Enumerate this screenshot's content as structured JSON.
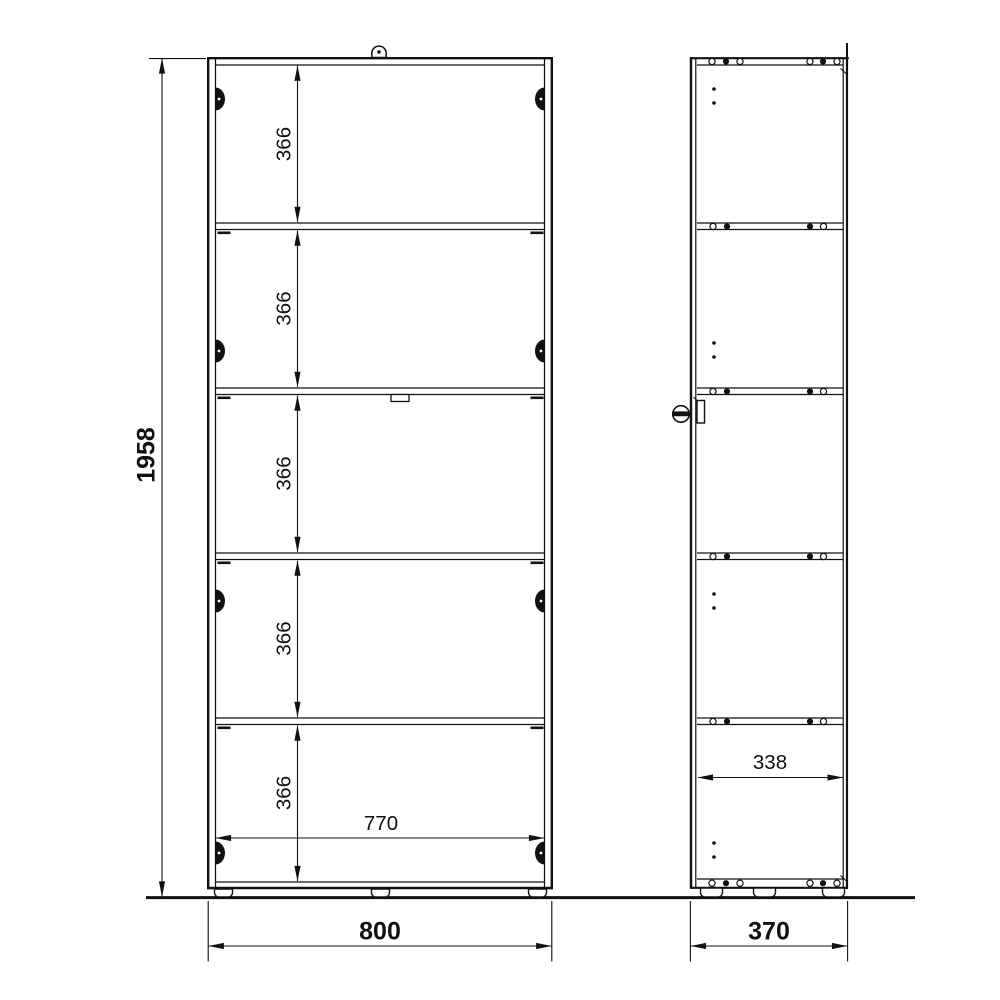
{
  "drawing": {
    "line_color": "#111111",
    "background_color": "#ffffff",
    "front_view": {
      "overall_height": "1958",
      "overall_width": "800",
      "interior_width": "770",
      "compartments": [
        "366",
        "366",
        "366",
        "366",
        "366"
      ]
    },
    "side_view": {
      "overall_depth": "370",
      "interior_depth": "338"
    }
  }
}
